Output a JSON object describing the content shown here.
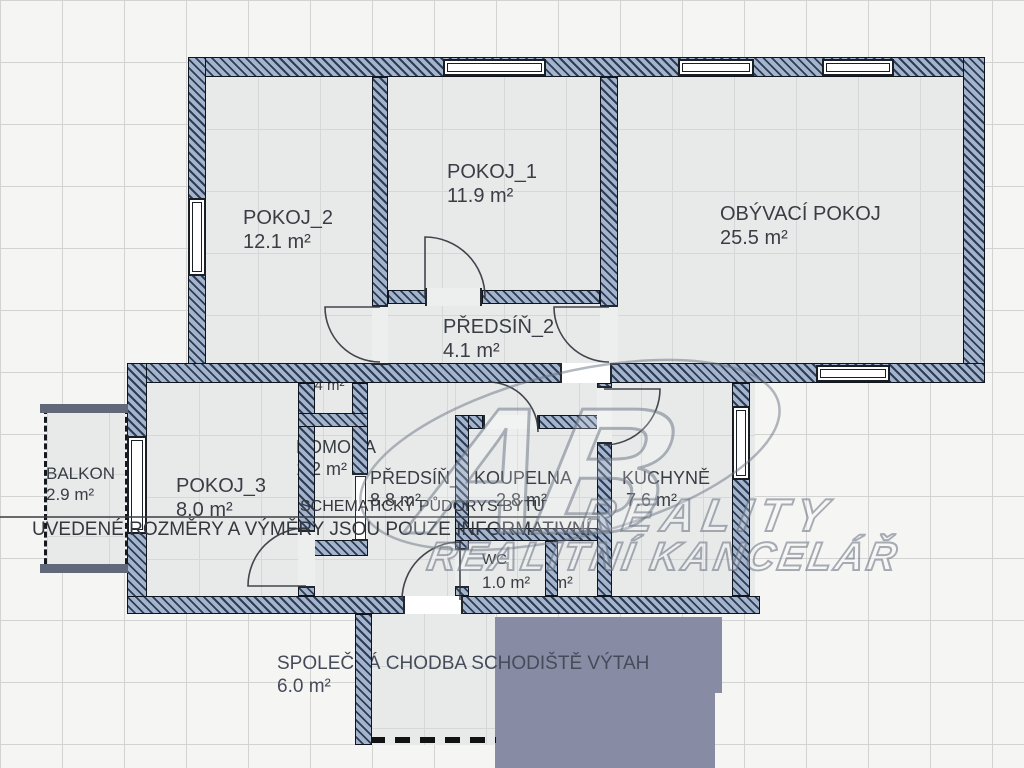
{
  "plan": {
    "rooms": {
      "pokoj1": {
        "name": "POKOJ_1",
        "area": "11.9 m²"
      },
      "pokoj2": {
        "name": "POKOJ_2",
        "area": "12.1 m²"
      },
      "obyvaci_pokoj": {
        "name": "OBÝVACÍ POKOJ",
        "area": "25.5 m²"
      },
      "predsin2": {
        "name": "PŘEDSÍŇ_2",
        "area": "4.1 m²"
      },
      "pokoj3": {
        "name": "POKOJ_3",
        "area": "8.0 m²"
      },
      "komora": {
        "name": "KOMORA",
        "area": "1.2 m²"
      },
      "nika": {
        "name": "",
        "area": "0.4 m²"
      },
      "predsin1": {
        "name": "PŘEDSÍŇ_1",
        "area": "8.8 m²"
      },
      "koupelna": {
        "name": "KOUPELNA",
        "area": "2.8 m²"
      },
      "kuchyne": {
        "name": "KUCHYNĚ",
        "area": "7.6 m²"
      },
      "wc": {
        "name": "WC",
        "area": "1.0 m²"
      },
      "mistnost2": {
        "name": "",
        "area": "m²"
      },
      "balkon": {
        "name": "BALKON",
        "area": "2.9 m²"
      },
      "spolecna_chodba": {
        "name": "SPOLEČNÁ CHODBA SCHODIŠTĚ VÝTAH",
        "area": "6.0 m²"
      }
    },
    "notes": {
      "line1": "SCHEMATICKÝ PŮDORYS BYTU",
      "line2": "UVEDENÉ ROZMĚRY A VÝMĚRY JSOU POUZE INFORMATIVNÍ"
    },
    "watermark": {
      "logo": "AB",
      "line1": "REALITY",
      "line2": "REALITNÍ KANCELÁŘ"
    },
    "colors": {
      "wall_fill": "#a3b4cb",
      "wall_stripe": "#2c3c58",
      "floor": "#e8eaea",
      "stair_block": "#878ca4",
      "outside": "#f5f5f3"
    }
  }
}
